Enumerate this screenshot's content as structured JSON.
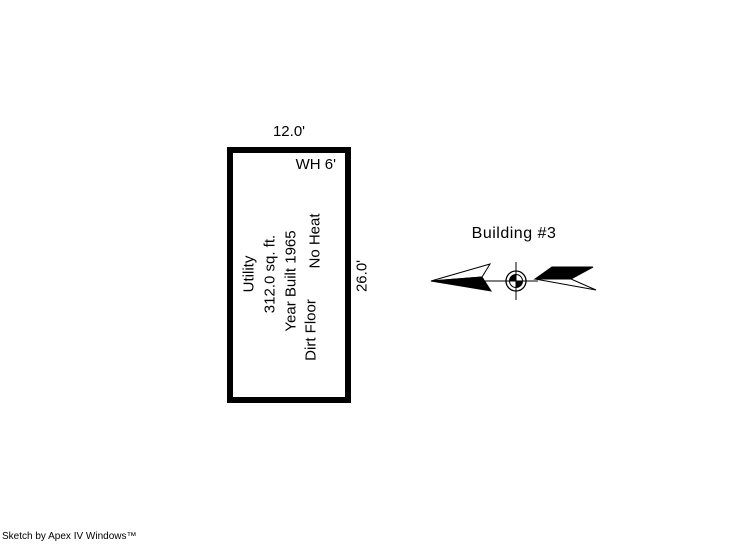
{
  "sketch": {
    "building_title": "Building #3",
    "credit": "Sketch by Apex IV Windows™",
    "unit": {
      "width_dim": "12.0'",
      "height_dim": "26.0'",
      "wall_height": "WH 6'",
      "use_label": "Utility",
      "area_label": "312.0 sq. ft.",
      "year_built_label": "Year Built 1965",
      "floor_label": "Dirt Floor",
      "heat_label": "No Heat"
    },
    "colors": {
      "line": "#000000",
      "background": "#ffffff"
    }
  }
}
